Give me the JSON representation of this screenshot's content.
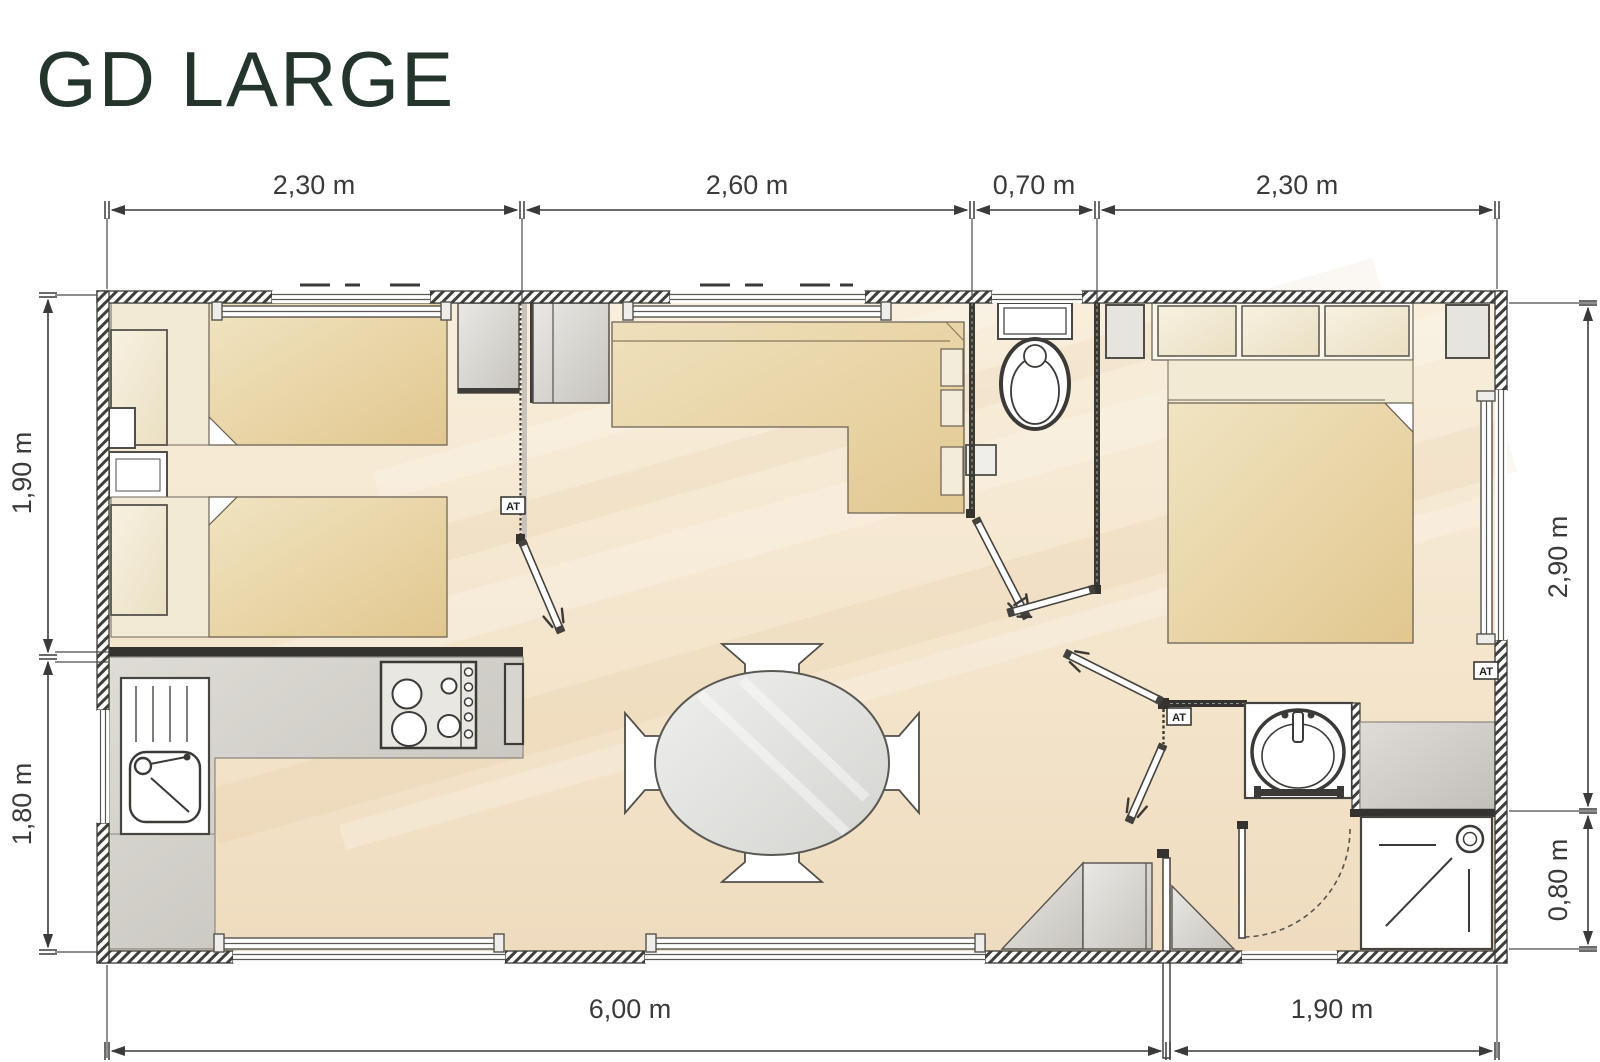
{
  "title": "GD LARGE",
  "dimensions": {
    "top": [
      "2,30 m",
      "2,60 m",
      "0,70 m",
      "2,30 m"
    ],
    "bottom": [
      "6,00 m",
      "1,90 m"
    ],
    "left": [
      "1,90 m",
      "1,80 m"
    ],
    "right": [
      "2,90 m",
      "0,80 m"
    ]
  },
  "vent": {
    "label": "AT"
  },
  "colors": {
    "title": "#24352c",
    "dimension_text": "#3a3a3a",
    "wall_hatch": "#3f3f3c",
    "furniture_tan": "#e5cc94",
    "pillow_cream": "#f3ecdb",
    "cabinet_gray": "#d4d1cb",
    "floor": "#f5e8d3",
    "fixture_white": "#ffffff"
  }
}
